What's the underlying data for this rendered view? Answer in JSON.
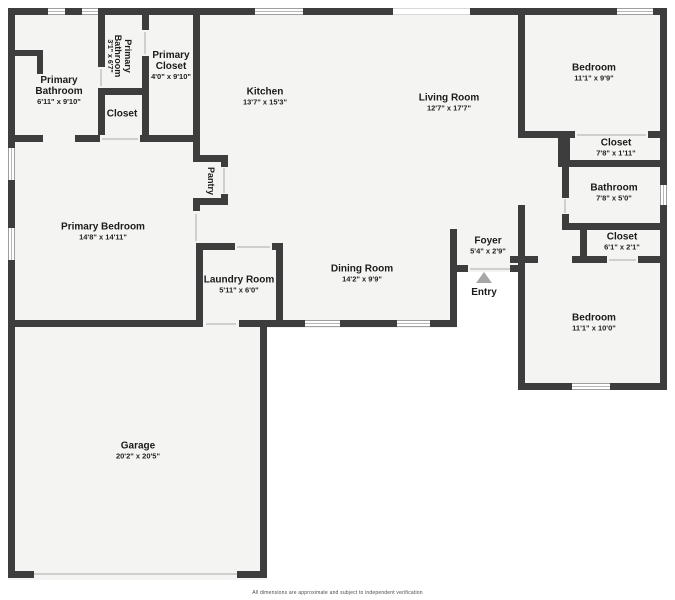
{
  "colors": {
    "wall": "#3d3d3d",
    "floor": "#f4f4f3",
    "background": "#ffffff",
    "window_frame": "#9f9f9f",
    "entry_arrow": "#a6a6a6",
    "label_text": "#1b1b1b"
  },
  "rooms": {
    "primary_bathroom": {
      "name": "Primary Bathroom",
      "dims": "6'11\" x 9'10\""
    },
    "primary_bathroom_small": {
      "name": "Primary Bathroom",
      "dims": "3'1\" x 6'7\""
    },
    "primary_closet": {
      "name": "Primary Closet",
      "dims": "4'0\" x 9'10\""
    },
    "closet_top_left": {
      "name": "Closet"
    },
    "kitchen": {
      "name": "Kitchen",
      "dims": "13'7\" x 15'3\""
    },
    "living_room": {
      "name": "Living Room",
      "dims": "12'7\" x 17'7\""
    },
    "pantry": {
      "name": "Pantry"
    },
    "primary_bedroom": {
      "name": "Primary Bedroom",
      "dims": "14'8\" x 14'11\""
    },
    "laundry_room": {
      "name": "Laundry Room",
      "dims": "5'11\" x 6'0\""
    },
    "dining_room": {
      "name": "Dining Room",
      "dims": "14'2\" x 9'9\""
    },
    "foyer": {
      "name": "Foyer",
      "dims": "5'4\" x 2'9\""
    },
    "entry": {
      "name": "Entry"
    },
    "garage": {
      "name": "Garage",
      "dims": "20'2\" x 20'5\""
    },
    "bedroom_top_right": {
      "name": "Bedroom",
      "dims": "11'1\" x 9'9\""
    },
    "closet_top_right": {
      "name": "Closet",
      "dims": "7'8\" x 1'11\""
    },
    "bathroom_right": {
      "name": "Bathroom",
      "dims": "7'8\" x 5'0\""
    },
    "closet_right": {
      "name": "Closet",
      "dims": "6'1\" x 2'1\""
    },
    "bedroom_bottom_right": {
      "name": "Bedroom",
      "dims": "11'1\" x 10'0\""
    }
  },
  "footer": {
    "disclaimer": "All dimensions are approximate and subject to independent verification"
  }
}
